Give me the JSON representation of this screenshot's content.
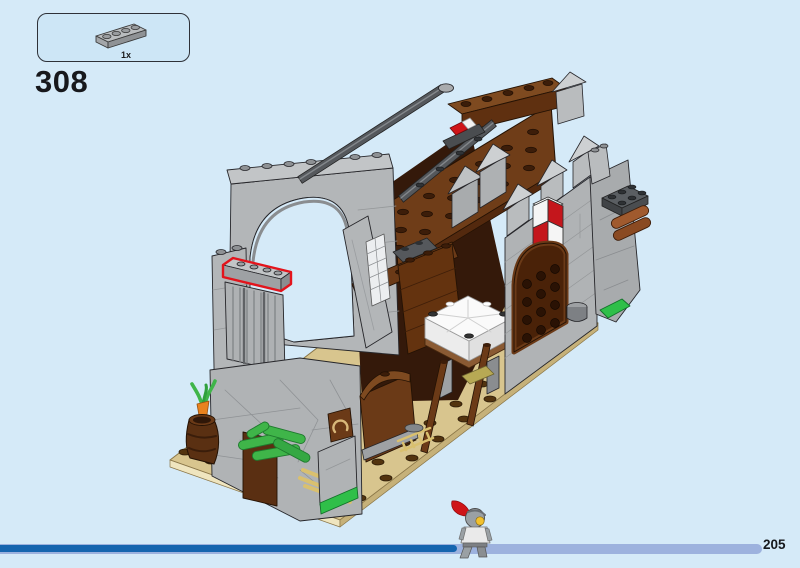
{
  "page": {
    "background_color": "#d5eaf8",
    "step_number": "308",
    "page_number": "205"
  },
  "parts_callout": {
    "items": [
      {
        "part_icon": "plate-1x4-light-gray-icon",
        "quantity": "1x",
        "part_color": "#b9bcbe"
      }
    ]
  },
  "illustration": {
    "type": "lego-assembly-step-isometric-view",
    "highlight_color": "#e3141c",
    "highlighted_part": "plate-1x4-outlined-in-red-on-left-wall-top",
    "palette": {
      "light_gray": "#b0b3b6",
      "dark_gray": "#55585c",
      "reddish_brown": "#6b3a17",
      "dark_brown": "#3a1c0b",
      "tan": "#d8c58e",
      "bright_green": "#3fb549",
      "red": "#cf1418",
      "white": "#f5f5f5",
      "shield_red": "#c4161c",
      "carrot_orange": "#e8821e"
    }
  },
  "progress_bar": {
    "track_color": "#9db2de",
    "fill_color": "#1565af",
    "fraction": 0.6,
    "marker_icon": "knight-minifigure-icon"
  }
}
